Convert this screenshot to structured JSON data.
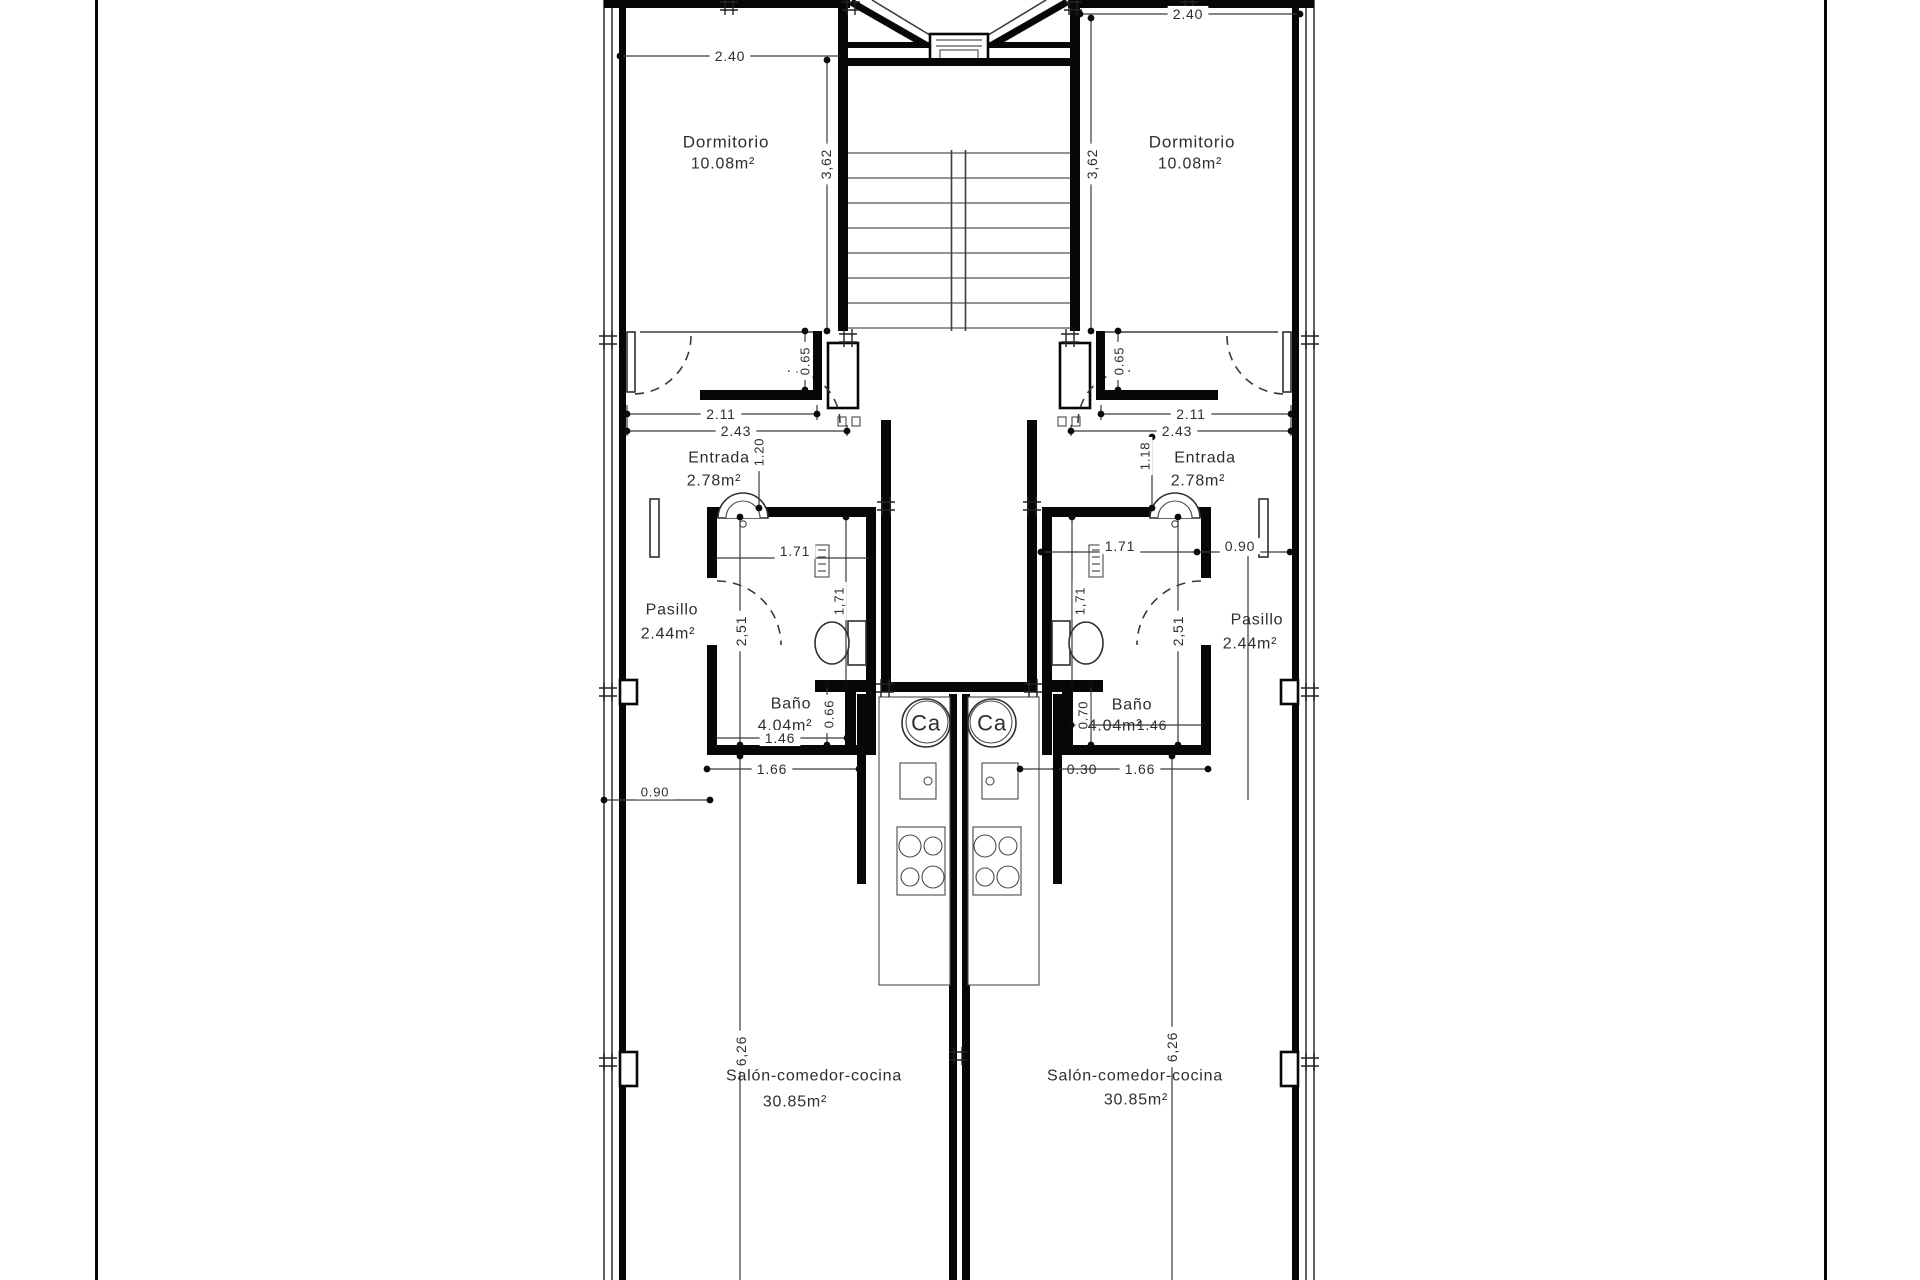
{
  "sheet": {
    "kind_visible": "architectural floor plan, two mirrored apartments around a central stair core"
  },
  "plan_summary": {
    "apartment_left": {
      "rooms": [
        {
          "name": "Dormitorio",
          "area": "10.08m²"
        },
        {
          "name": "Entrada",
          "area": "2.78m²"
        },
        {
          "name": "Pasillo",
          "area": "2.44m²"
        },
        {
          "name": "Baño",
          "area": "4.04m²"
        },
        {
          "name": "Salón-comedor-cocina",
          "area": "30.85m²"
        }
      ],
      "dimensions_m": [
        "2.40",
        "3,62",
        "0.65",
        "2.11",
        "2.43",
        "1.20",
        "1.71",
        "2,51",
        "1,71",
        "0.66",
        "1.46",
        "1.66",
        "0.90",
        "6,26"
      ]
    },
    "apartment_right": {
      "rooms": [
        {
          "name": "Dormitorio",
          "area": "10.08m²"
        },
        {
          "name": "Entrada",
          "area": "2.78m²"
        },
        {
          "name": "Pasillo",
          "area": "2.44m²"
        },
        {
          "name": "Baño",
          "area": "4.04m²"
        },
        {
          "name": "Salón-comedor-cocina",
          "area": "30.85m²"
        }
      ],
      "dimensions_m": [
        "2.40",
        "3,62",
        "0.65",
        "2.11",
        "2.43",
        "1.18",
        "1.71",
        "0.90",
        "2,51",
        "1,71",
        "0.70",
        "1.46",
        "0.30",
        "1.66",
        "6,26"
      ]
    },
    "symbols": {
      "boiler_label": "Ca"
    }
  },
  "annotations": [
    {
      "id": "dorm-l-name",
      "text": "Dormitorio",
      "x": 726,
      "y": 142,
      "rot": 0,
      "size": 17,
      "bg": false
    },
    {
      "id": "dorm-l-area",
      "text": "10.08m²",
      "x": 723,
      "y": 164,
      "rot": 0,
      "size": 16,
      "bg": false
    },
    {
      "id": "dim-240-l",
      "text": "2.40",
      "x": 730,
      "y": 56,
      "rot": 0,
      "size": 14,
      "bg": true
    },
    {
      "id": "dim-362-l",
      "text": "3,62",
      "x": 826,
      "y": 164,
      "rot": -90,
      "size": 14,
      "bg": true
    },
    {
      "id": "dim-065-l",
      "text": "0.65",
      "x": 805,
      "y": 361,
      "rot": -90,
      "size": 13,
      "bg": true
    },
    {
      "id": "dim-211-l",
      "text": "2.11",
      "x": 721,
      "y": 414,
      "rot": 0,
      "size": 14,
      "bg": true
    },
    {
      "id": "dim-243-l",
      "text": "2.43",
      "x": 736,
      "y": 431,
      "rot": 0,
      "size": 14,
      "bg": true
    },
    {
      "id": "entrada-l-name",
      "text": "Entrada",
      "x": 719,
      "y": 458,
      "rot": 0,
      "size": 16,
      "bg": false
    },
    {
      "id": "entrada-l-area",
      "text": "2.78m²",
      "x": 714,
      "y": 481,
      "rot": 0,
      "size": 16,
      "bg": false
    },
    {
      "id": "dim-120-l",
      "text": "1.20",
      "x": 759,
      "y": 452,
      "rot": -90,
      "size": 13,
      "bg": true
    },
    {
      "id": "dim-171h-l",
      "text": "1.71",
      "x": 795,
      "y": 551,
      "rot": 0,
      "size": 14,
      "bg": true
    },
    {
      "id": "pasillo-l-name",
      "text": "Pasillo",
      "x": 672,
      "y": 610,
      "rot": 0,
      "size": 16,
      "bg": false
    },
    {
      "id": "pasillo-l-area",
      "text": "2.44m²",
      "x": 668,
      "y": 634,
      "rot": 0,
      "size": 16,
      "bg": false
    },
    {
      "id": "dim-251-l",
      "text": "2,51",
      "x": 741,
      "y": 631,
      "rot": -90,
      "size": 14,
      "bg": true
    },
    {
      "id": "dim-171v-l",
      "text": "1,71",
      "x": 839,
      "y": 601,
      "rot": -90,
      "size": 13,
      "bg": true
    },
    {
      "id": "dim-066-l",
      "text": "0.66",
      "x": 829,
      "y": 714,
      "rot": -90,
      "size": 13,
      "bg": true
    },
    {
      "id": "bano-l-name",
      "text": "Baño",
      "x": 791,
      "y": 704,
      "rot": 0,
      "size": 16,
      "bg": false
    },
    {
      "id": "bano-l-area",
      "text": "4.04m²",
      "x": 785,
      "y": 726,
      "rot": 0,
      "size": 16,
      "bg": false
    },
    {
      "id": "dim-146-l",
      "text": "1.46",
      "x": 780,
      "y": 738,
      "rot": 0,
      "size": 14,
      "bg": true
    },
    {
      "id": "dim-166-l",
      "text": "1.66",
      "x": 772,
      "y": 769,
      "rot": 0,
      "size": 14,
      "bg": true
    },
    {
      "id": "dim-090-l",
      "text": "0.90",
      "x": 655,
      "y": 792,
      "rot": 0,
      "size": 13,
      "bg": true
    },
    {
      "id": "ca-l",
      "text": "Ca",
      "x": 926,
      "y": 723,
      "rot": 0,
      "size": 22,
      "bg": false
    },
    {
      "id": "dim-626-l",
      "text": "6,26",
      "x": 741,
      "y": 1051,
      "rot": -90,
      "size": 14,
      "bg": true
    },
    {
      "id": "salon-l-name",
      "text": "Salón-comedor-cocina",
      "x": 814,
      "y": 1076,
      "rot": 0,
      "size": 16,
      "bg": false
    },
    {
      "id": "salon-l-area",
      "text": "30.85m²",
      "x": 795,
      "y": 1102,
      "rot": 0,
      "size": 16,
      "bg": false
    },
    {
      "id": "dorm-r-name",
      "text": "Dormitorio",
      "x": 1192,
      "y": 142,
      "rot": 0,
      "size": 17,
      "bg": false
    },
    {
      "id": "dorm-r-area",
      "text": "10.08m²",
      "x": 1190,
      "y": 164,
      "rot": 0,
      "size": 16,
      "bg": false
    },
    {
      "id": "dim-240-r",
      "text": "2.40",
      "x": 1188,
      "y": 14,
      "rot": 0,
      "size": 14,
      "bg": true
    },
    {
      "id": "dim-362-r",
      "text": "3,62",
      "x": 1092,
      "y": 164,
      "rot": -90,
      "size": 14,
      "bg": true
    },
    {
      "id": "dim-065-r",
      "text": "0.65",
      "x": 1119,
      "y": 361,
      "rot": -90,
      "size": 13,
      "bg": true
    },
    {
      "id": "dim-211-r",
      "text": "2.11",
      "x": 1191,
      "y": 414,
      "rot": 0,
      "size": 14,
      "bg": true
    },
    {
      "id": "dim-243-r",
      "text": "2.43",
      "x": 1177,
      "y": 431,
      "rot": 0,
      "size": 14,
      "bg": true
    },
    {
      "id": "entrada-r-name",
      "text": "Entrada",
      "x": 1205,
      "y": 458,
      "rot": 0,
      "size": 16,
      "bg": false
    },
    {
      "id": "entrada-r-area",
      "text": "2.78m²",
      "x": 1198,
      "y": 481,
      "rot": 0,
      "size": 16,
      "bg": false
    },
    {
      "id": "dim-118-r",
      "text": "1.18",
      "x": 1145,
      "y": 456,
      "rot": -90,
      "size": 13,
      "bg": true
    },
    {
      "id": "dim-171h-r",
      "text": "1.71",
      "x": 1120,
      "y": 546,
      "rot": 0,
      "size": 14,
      "bg": true
    },
    {
      "id": "dim-090-r",
      "text": "0.90",
      "x": 1240,
      "y": 546,
      "rot": 0,
      "size": 14,
      "bg": true
    },
    {
      "id": "pasillo-r-name",
      "text": "Pasillo",
      "x": 1257,
      "y": 620,
      "rot": 0,
      "size": 16,
      "bg": false
    },
    {
      "id": "pasillo-r-area",
      "text": "2.44m²",
      "x": 1250,
      "y": 644,
      "rot": 0,
      "size": 16,
      "bg": false
    },
    {
      "id": "dim-251-r",
      "text": "2,51",
      "x": 1178,
      "y": 631,
      "rot": -90,
      "size": 14,
      "bg": true
    },
    {
      "id": "dim-171v-r",
      "text": "1,71",
      "x": 1080,
      "y": 601,
      "rot": -90,
      "size": 13,
      "bg": true
    },
    {
      "id": "dim-070-r",
      "text": "0.70",
      "x": 1083,
      "y": 715,
      "rot": -90,
      "size": 13,
      "bg": true
    },
    {
      "id": "bano-r-name",
      "text": "Baño",
      "x": 1132,
      "y": 705,
      "rot": 0,
      "size": 16,
      "bg": false
    },
    {
      "id": "bano-r-area",
      "text": "4.04m²",
      "x": 1115,
      "y": 726,
      "rot": 0,
      "size": 16,
      "bg": false
    },
    {
      "id": "dim-146-r",
      "text": "1.46",
      "x": 1152,
      "y": 725,
      "rot": 0,
      "size": 14,
      "bg": false
    },
    {
      "id": "dim-030-r",
      "text": "0.30",
      "x": 1082,
      "y": 769,
      "rot": 0,
      "size": 14,
      "bg": false
    },
    {
      "id": "dim-166-r",
      "text": "1.66",
      "x": 1140,
      "y": 769,
      "rot": 0,
      "size": 14,
      "bg": true
    },
    {
      "id": "ca-r",
      "text": "Ca",
      "x": 992,
      "y": 723,
      "rot": 0,
      "size": 22,
      "bg": false
    },
    {
      "id": "dim-626-r",
      "text": "6,26",
      "x": 1172,
      "y": 1047,
      "rot": -90,
      "size": 14,
      "bg": true
    },
    {
      "id": "salon-r-name",
      "text": "Salón-comedor-cocina",
      "x": 1135,
      "y": 1076,
      "rot": 0,
      "size": 16,
      "bg": false
    },
    {
      "id": "salon-r-area",
      "text": "30.85m²",
      "x": 1136,
      "y": 1100,
      "rot": 0,
      "size": 16,
      "bg": false
    }
  ]
}
